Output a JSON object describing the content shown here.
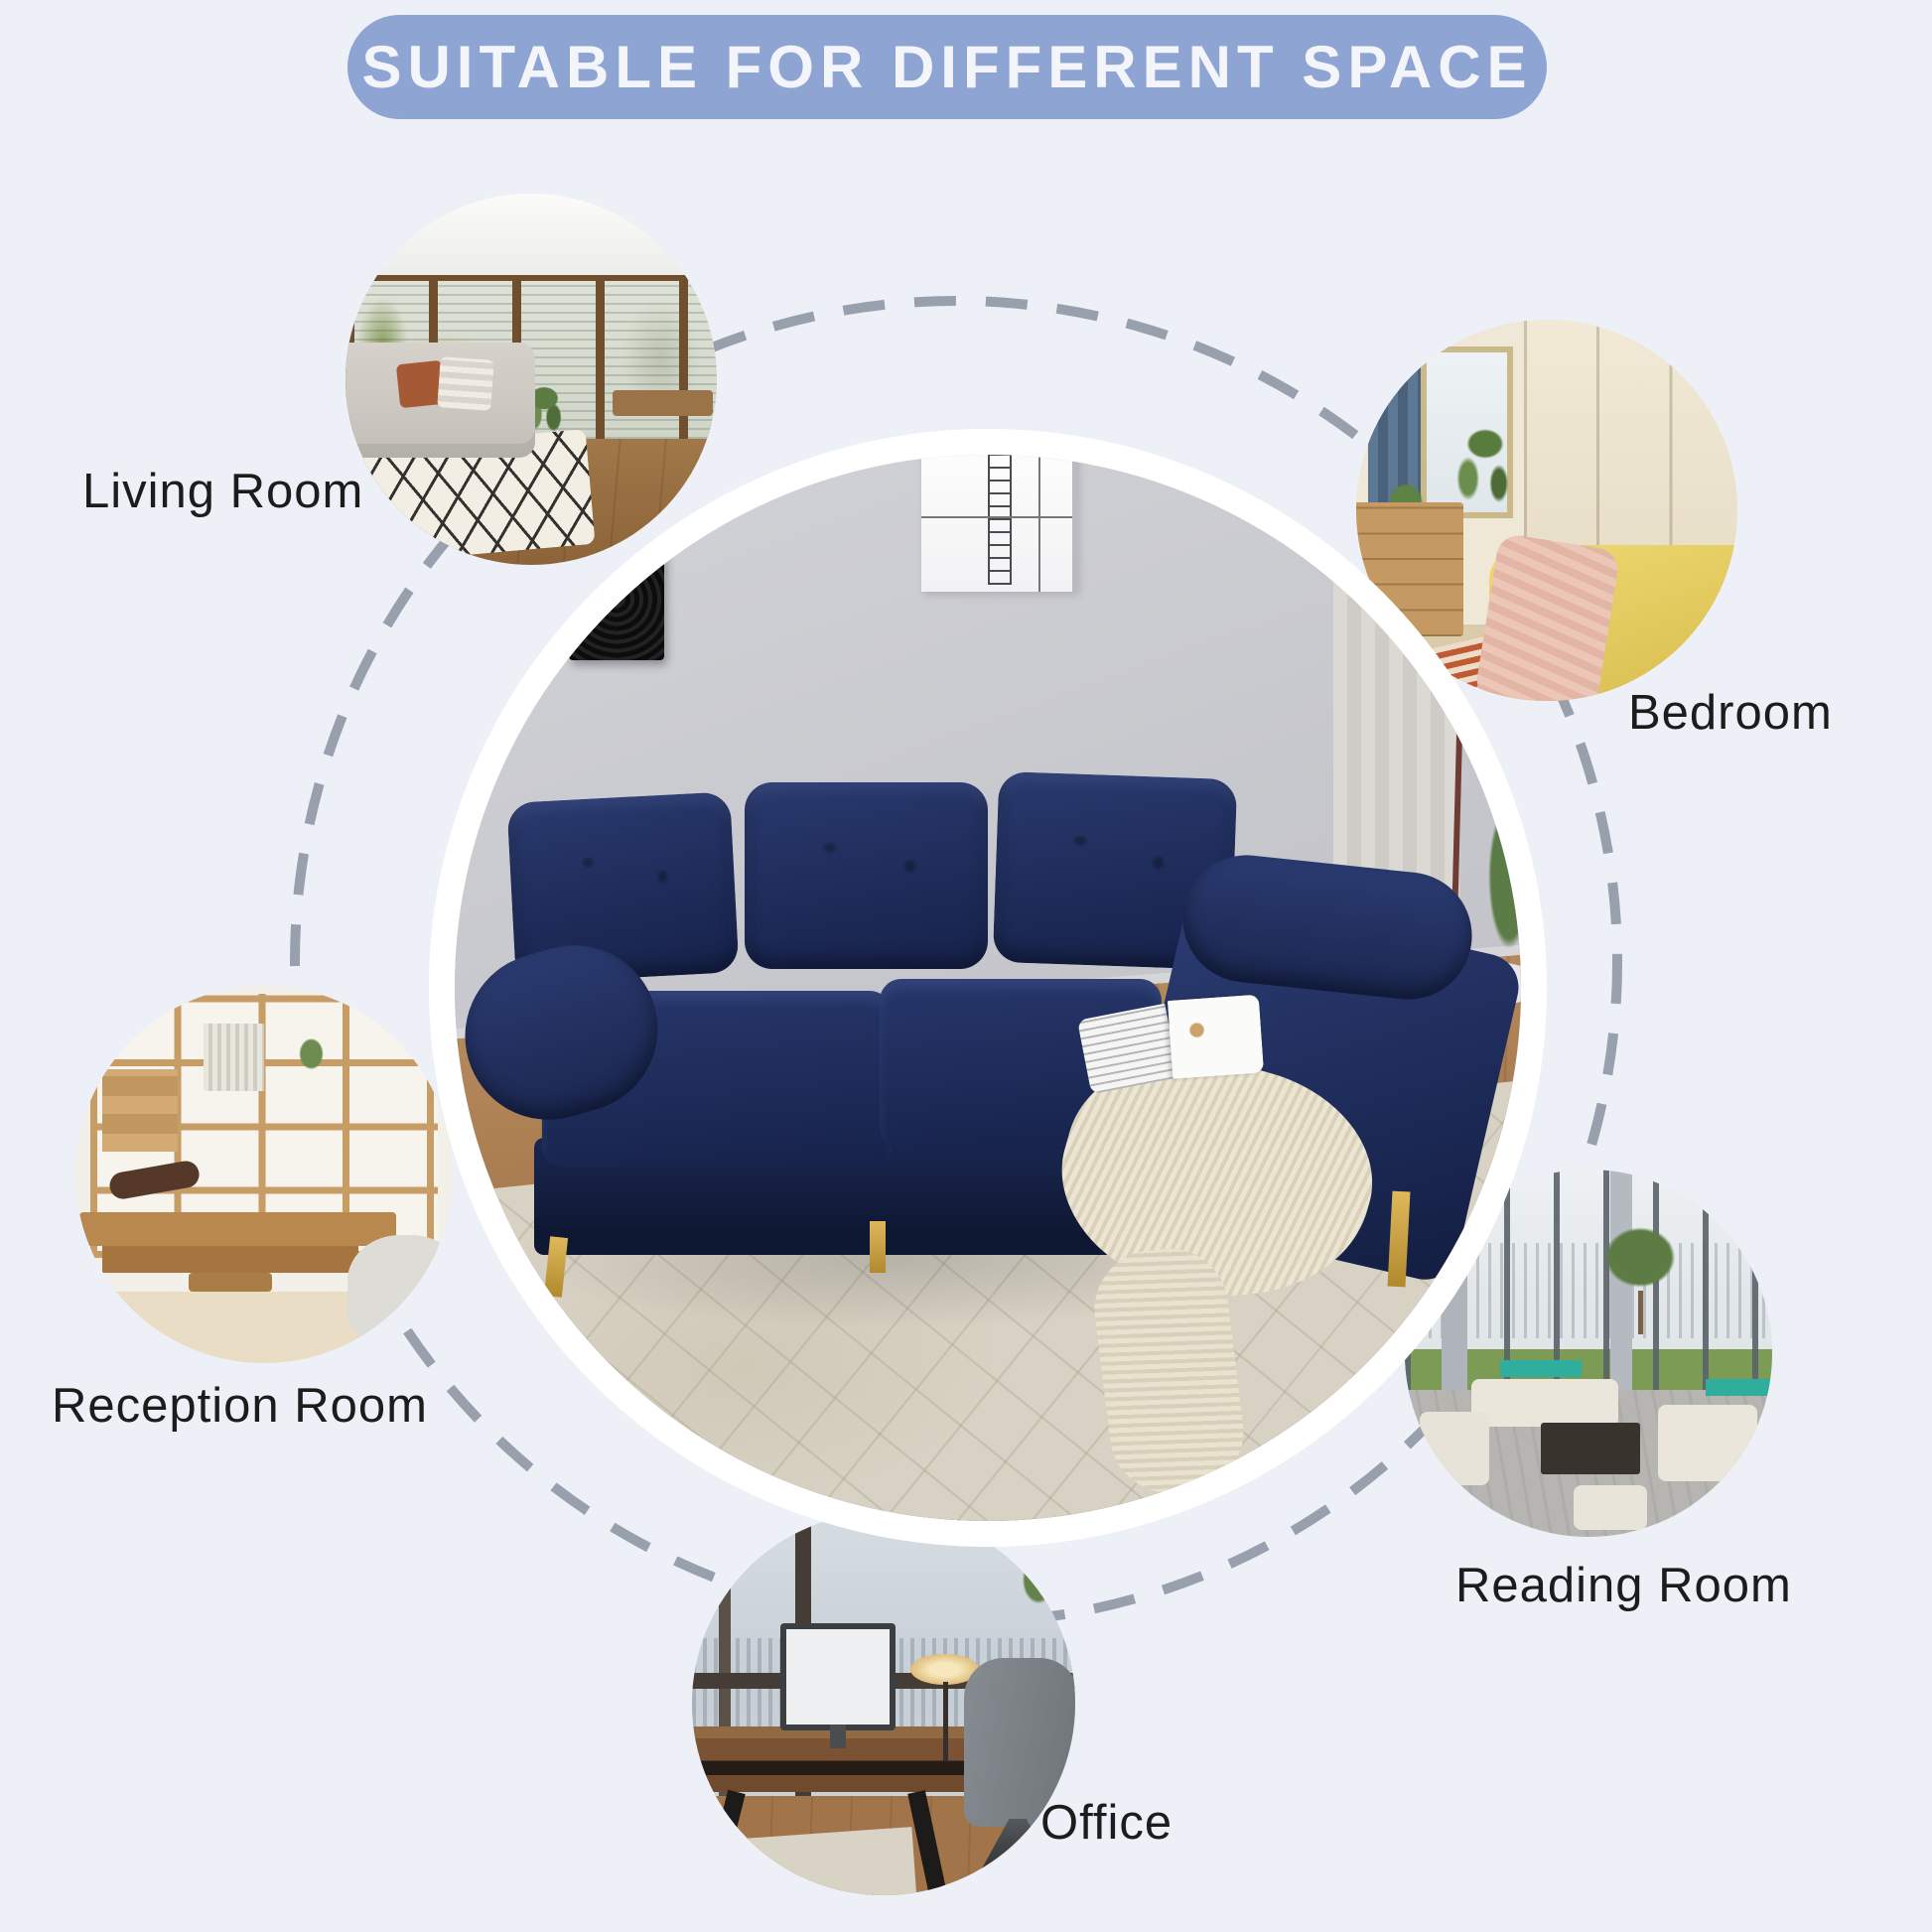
{
  "title": "SUITABLE FOR DIFFERENT SPACE",
  "spaces": [
    {
      "id": "living-room",
      "label": "Living Room",
      "photo": "living-room-interior-photo"
    },
    {
      "id": "bedroom",
      "label": "Bedroom",
      "photo": "bedroom-interior-photo"
    },
    {
      "id": "reception-room",
      "label": "Reception Room",
      "photo": "reception-room-interior-photo"
    },
    {
      "id": "reading-room",
      "label": "Reading Room",
      "photo": "reading-lounge-interior-photo"
    },
    {
      "id": "office",
      "label": "Office",
      "photo": "office-interior-photo"
    }
  ],
  "center_photo": "navy-sectional-sofa-room-photo",
  "colors": {
    "background": "#edf0f6",
    "title_pill": "#8ea5d3",
    "title_text": "#f3f5fa",
    "label_text": "#1c1c1c",
    "dashed_circle": "#99a0ad",
    "sofa_navy": "#1e2c5a",
    "sofa_leg_gold": "#c8a042",
    "center_ring": "#ffffff"
  }
}
